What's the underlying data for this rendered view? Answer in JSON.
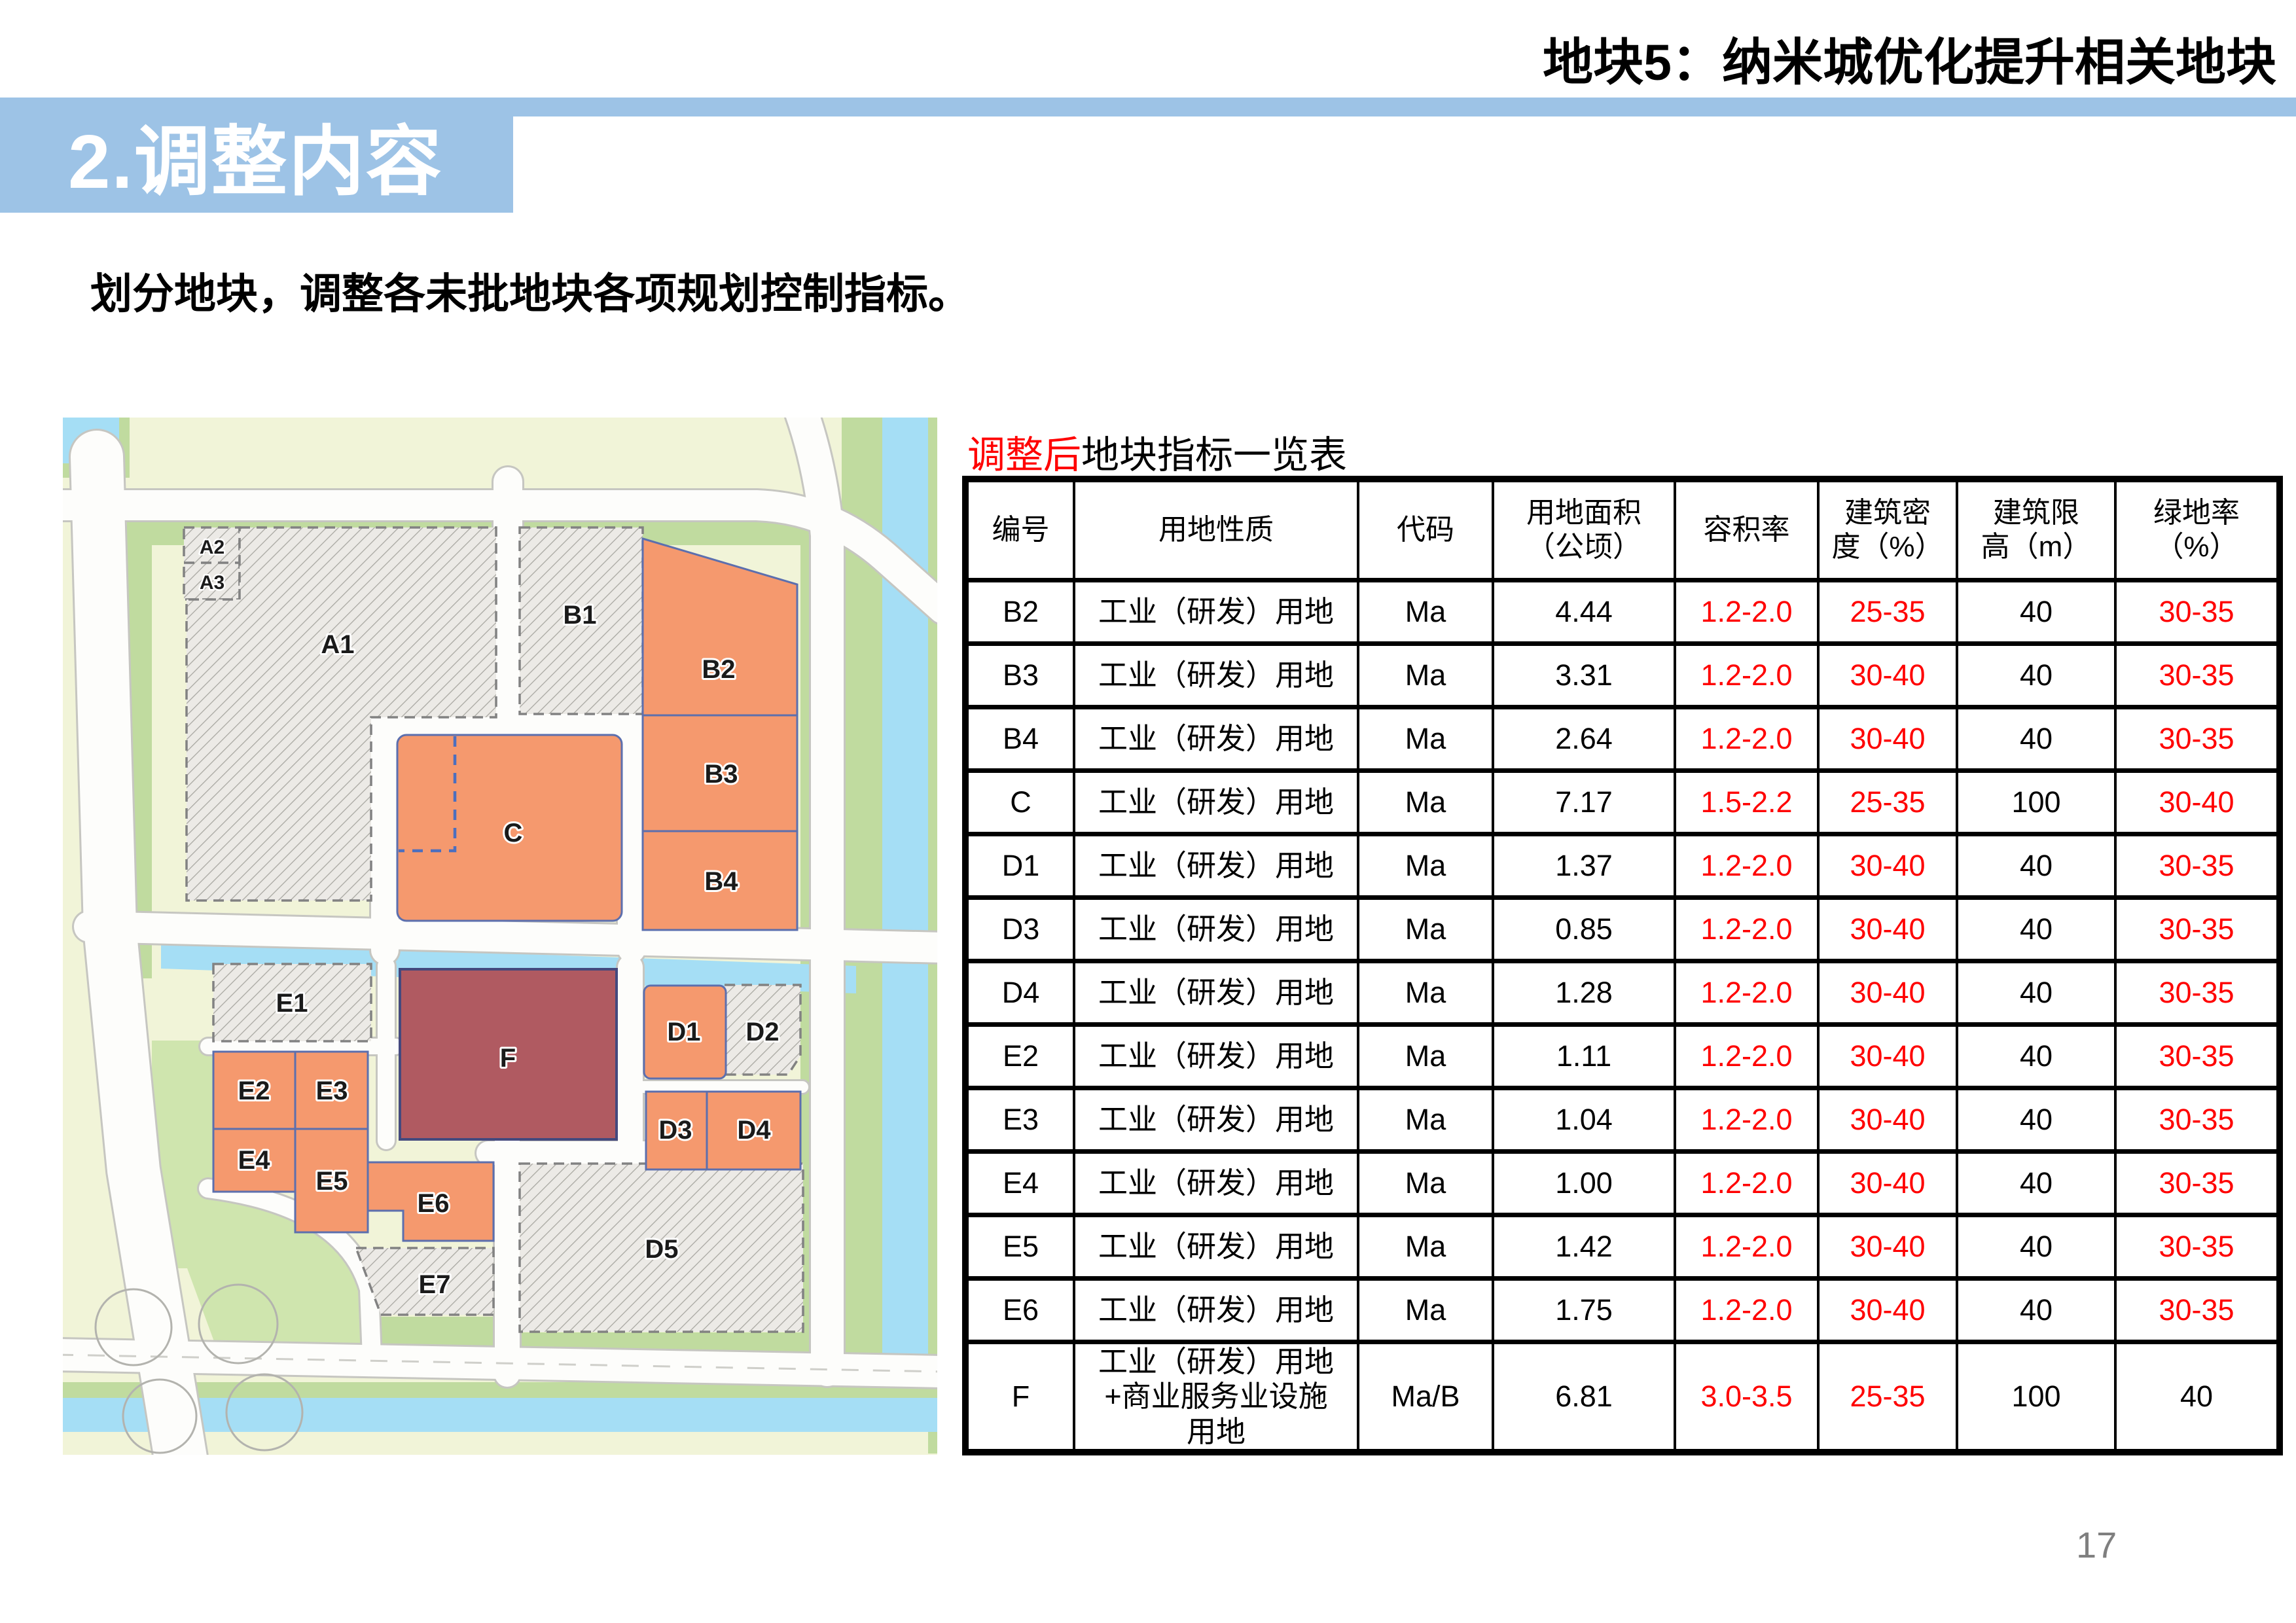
{
  "slide_title": "地块5：纳米城优化提升相关地块",
  "banner": {
    "title": "2.调整内容"
  },
  "subtitle": "划分地块，调整各未批地块各项规划控制指标。",
  "table": {
    "title_highlight": "调整后",
    "title_rest": "地块指标一览表",
    "columns": [
      "编号",
      "用地性质",
      "代码",
      "用地面积\n（公顷）",
      "容积率",
      "建筑密\n度（%）",
      "建筑限\n高（m）",
      "绿地率\n（%）"
    ],
    "rows": [
      {
        "id": "B2",
        "use": "工业（研发）用地",
        "code": "Ma",
        "area": "4.44",
        "far": "1.2-2.0",
        "density": "25-35",
        "height": "40",
        "green": "30-35"
      },
      {
        "id": "B3",
        "use": "工业（研发）用地",
        "code": "Ma",
        "area": "3.31",
        "far": "1.2-2.0",
        "density": "30-40",
        "height": "40",
        "green": "30-35"
      },
      {
        "id": "B4",
        "use": "工业（研发）用地",
        "code": "Ma",
        "area": "2.64",
        "far": "1.2-2.0",
        "density": "30-40",
        "height": "40",
        "green": "30-35"
      },
      {
        "id": "C",
        "use": "工业（研发）用地",
        "code": "Ma",
        "area": "7.17",
        "far": "1.5-2.2",
        "density": "25-35",
        "height": "100",
        "green": "30-40"
      },
      {
        "id": "D1",
        "use": "工业（研发）用地",
        "code": "Ma",
        "area": "1.37",
        "far": "1.2-2.0",
        "density": "30-40",
        "height": "40",
        "green": "30-35"
      },
      {
        "id": "D3",
        "use": "工业（研发）用地",
        "code": "Ma",
        "area": "0.85",
        "far": "1.2-2.0",
        "density": "30-40",
        "height": "40",
        "green": "30-35"
      },
      {
        "id": "D4",
        "use": "工业（研发）用地",
        "code": "Ma",
        "area": "1.28",
        "far": "1.2-2.0",
        "density": "30-40",
        "height": "40",
        "green": "30-35"
      },
      {
        "id": "E2",
        "use": "工业（研发）用地",
        "code": "Ma",
        "area": "1.11",
        "far": "1.2-2.0",
        "density": "30-40",
        "height": "40",
        "green": "30-35"
      },
      {
        "id": "E3",
        "use": "工业（研发）用地",
        "code": "Ma",
        "area": "1.04",
        "far": "1.2-2.0",
        "density": "30-40",
        "height": "40",
        "green": "30-35"
      },
      {
        "id": "E4",
        "use": "工业（研发）用地",
        "code": "Ma",
        "area": "1.00",
        "far": "1.2-2.0",
        "density": "30-40",
        "height": "40",
        "green": "30-35"
      },
      {
        "id": "E5",
        "use": "工业（研发）用地",
        "code": "Ma",
        "area": "1.42",
        "far": "1.2-2.0",
        "density": "30-40",
        "height": "40",
        "green": "30-35"
      },
      {
        "id": "E6",
        "use": "工业（研发）用地",
        "code": "Ma",
        "area": "1.75",
        "far": "1.2-2.0",
        "density": "30-40",
        "height": "40",
        "green": "30-35"
      },
      {
        "id": "F",
        "use": "工业（研发）用地\n+商业服务业设施\n用地",
        "code": "Ma/B",
        "area": "6.81",
        "far": "3.0-3.5",
        "density": "25-35",
        "height": "100",
        "green": "40"
      }
    ]
  },
  "map": {
    "labels": {
      "a1": "A1",
      "a2": "A2",
      "a3": "A3",
      "b1": "B1",
      "b2": "B2",
      "b3": "B3",
      "b4": "B4",
      "c": "C",
      "d1": "D1",
      "d2": "D2",
      "d3": "D3",
      "d4": "D4",
      "d5": "D5",
      "e1": "E1",
      "e2": "E2",
      "e3": "E3",
      "e4": "E4",
      "e5": "E5",
      "e6": "E6",
      "e7": "E7",
      "f": "F"
    }
  },
  "page_number": "17",
  "colors": {
    "banner_blue": "#9dc3e6",
    "highlight_red": "#ff0000",
    "plot_orange": "#f5996e",
    "plot_dark_red": "#b05a61",
    "water_blue": "#a5def5",
    "page_number_gray": "#7f7f7f"
  }
}
